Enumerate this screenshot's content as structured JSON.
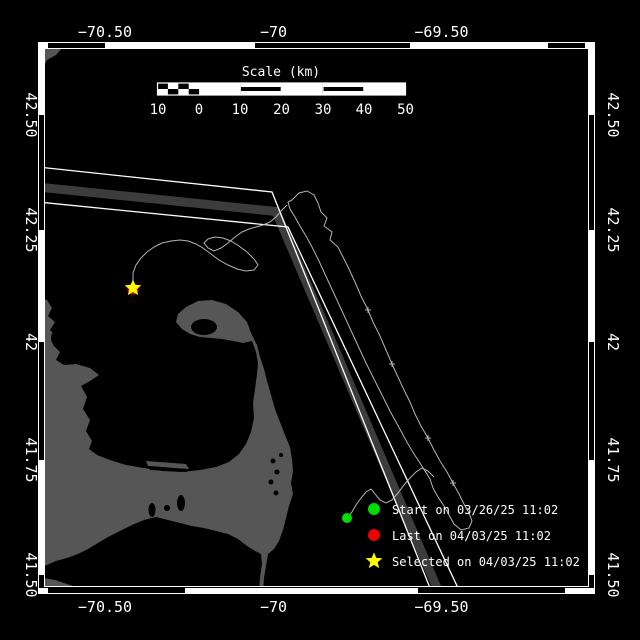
{
  "plot": {
    "axes": {
      "top": [
        "−70.50",
        "−70",
        "−69.50"
      ],
      "bottom": [
        "−70.50",
        "−70",
        "−69.50"
      ],
      "left": [
        "42.50",
        "42.25",
        "42",
        "41.75",
        "41.50"
      ],
      "right": [
        "42.50",
        "42.25",
        "42",
        "41.75",
        "41.50"
      ]
    },
    "scale_bar": {
      "title": "Scale (km)",
      "tick_labels": [
        "10",
        "0",
        "10",
        "20",
        "30",
        "40",
        "50"
      ]
    },
    "legend": {
      "items": [
        {
          "marker": "green-circle",
          "label": "Start on 03/26/25 11:02"
        },
        {
          "marker": "red-circle",
          "label": "Last on 04/03/25 11:02"
        },
        {
          "marker": "yellow-star",
          "label": "Selected on 04/03/25 11:02"
        }
      ]
    },
    "map_features": {
      "land": "Cape Cod and Massachusetts coast",
      "lane": "traffic separation scheme",
      "track": "drifter track"
    }
  },
  "colors": {
    "background": "#000000",
    "frame": "#ffffff",
    "land": "#565656",
    "separation_zone": "#3c3c3c",
    "track": "#b4b4b4",
    "start_green": "#00dd00",
    "last_red": "#ee0000",
    "selected_yellow": "#ffff00",
    "text": "#ffffff"
  }
}
